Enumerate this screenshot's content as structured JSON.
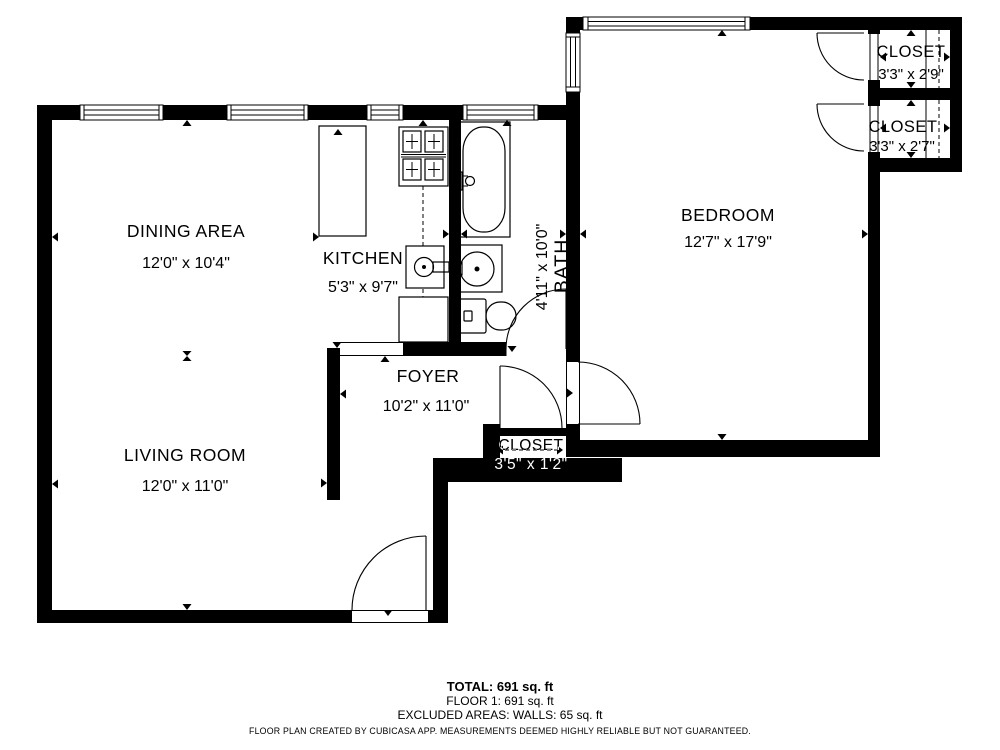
{
  "rooms": {
    "dining": {
      "name": "DINING AREA",
      "dims": "12'0\" x 10'4\""
    },
    "kitchen": {
      "name": "KITCHEN",
      "dims": "5'3\" x 9'7\""
    },
    "bath": {
      "name": "BATH",
      "dims": "4'11\" x 10'0\""
    },
    "bedroom": {
      "name": "BEDROOM",
      "dims": "12'7\" x 17'9\""
    },
    "closet_top": {
      "name": "CLOSET",
      "dims": "3'3\" x 2'9\""
    },
    "closet_bottom": {
      "name": "CLOSET",
      "dims": "3'3\" x 2'7\""
    },
    "foyer": {
      "name": "FOYER",
      "dims": "10'2\" x 11'0\""
    },
    "foyer_closet": {
      "name": "CLOSET",
      "dims": "3'5\" x 1'2\""
    },
    "living": {
      "name": "LIVING ROOM",
      "dims": "12'0\" x 11'0\""
    }
  },
  "footer": {
    "total": "TOTAL: 691 sq. ft",
    "floor": "FLOOR 1: 691 sq. ft",
    "excluded": "EXCLUDED AREAS: WALLS: 65 sq. ft",
    "disclaimer": "FLOOR PLAN CREATED BY CUBICASA APP. MEASUREMENTS DEEMED HIGHLY RELIABLE BUT NOT GUARANTEED."
  },
  "colors": {
    "wall": "#000000",
    "background": "#ffffff"
  }
}
